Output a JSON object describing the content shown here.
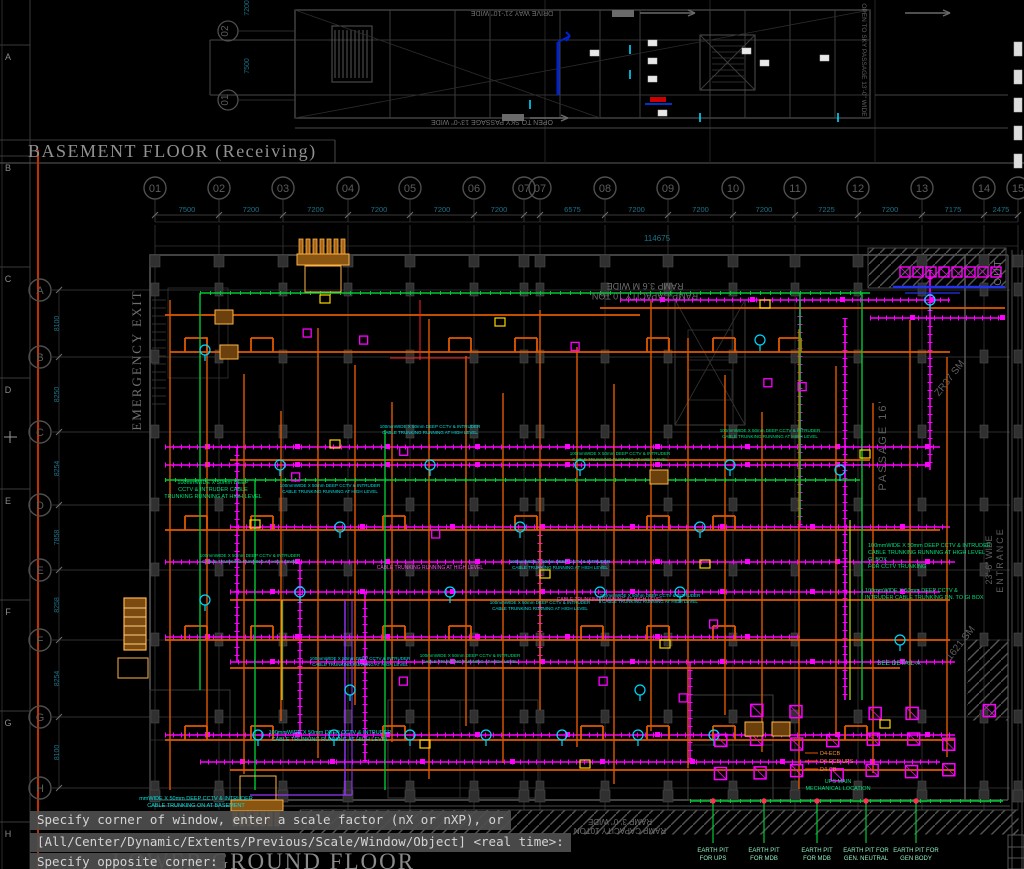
{
  "window": {
    "background": "#000000"
  },
  "titles": {
    "basement": "BASEMENT FLOOR (Receiving)",
    "ground_partial": "LOWER GROUND FLOOR"
  },
  "command_line": {
    "lines": [
      "Specify corner of window, enter a scale factor (nX or nXP), or",
      "[All/Center/Dynamic/Extents/Previous/Scale/Window/Object] <real time>:",
      "Specify opposite corner:"
    ]
  },
  "grid_columns": [
    {
      "label": "01",
      "x": 155,
      "dim_after": "7500"
    },
    {
      "label": "02",
      "x": 219,
      "dim_after": "7200"
    },
    {
      "label": "03",
      "x": 283,
      "dim_after": "7200"
    },
    {
      "label": "04",
      "x": 348,
      "dim_after": "7200"
    },
    {
      "label": "05",
      "x": 410,
      "dim_after": "7200"
    },
    {
      "label": "06",
      "x": 474,
      "dim_after": "7200"
    },
    {
      "label": "07",
      "x": 524,
      "dim_after": ""
    },
    {
      "label": "07",
      "x": 540,
      "dim_after": "6575"
    },
    {
      "label": "08",
      "x": 605,
      "dim_after": "7200"
    },
    {
      "label": "09",
      "x": 668,
      "dim_after": "7200"
    },
    {
      "label": "10",
      "x": 733,
      "dim_after": "7200"
    },
    {
      "label": "11",
      "x": 795,
      "dim_after": "7225"
    },
    {
      "label": "12",
      "x": 858,
      "dim_after": "7200"
    },
    {
      "label": "13",
      "x": 922,
      "dim_after": "7175"
    },
    {
      "label": "14",
      "x": 984,
      "dim_after": "2475"
    },
    {
      "label": "15",
      "x": 1018,
      "dim_after": ""
    }
  ],
  "grid_rows": [
    {
      "label": "A",
      "y": 290,
      "dim_after": "8100"
    },
    {
      "label": "B",
      "y": 357,
      "dim_after": "8250"
    },
    {
      "label": "C",
      "y": 432,
      "dim_after": "8254"
    },
    {
      "label": "D",
      "y": 505,
      "dim_after": "7858"
    },
    {
      "label": "E",
      "y": 570,
      "dim_after": "8258"
    },
    {
      "label": "F",
      "y": 640,
      "dim_after": "8254"
    },
    {
      "label": "G",
      "y": 717,
      "dim_after": "8100"
    },
    {
      "label": "H",
      "y": 788,
      "dim_after": ""
    }
  ],
  "overall_dim": "114675",
  "sheet_edge_letters": [
    "A",
    "B",
    "C",
    "D",
    "E",
    "F",
    "G",
    "H"
  ],
  "top_strip": {
    "bubbles": [
      {
        "label": "02"
      },
      {
        "label": "01"
      }
    ],
    "dims": [
      "7200",
      "7500"
    ],
    "drive_way": "DRIVE WAY 21'-10\" WIDE",
    "open_sky": "OPEN TO SKY PASSAGE 13'-0\" WIDE"
  },
  "labels": {
    "emergency_exit": "EMERGENCY EXIT",
    "ramp_capacity": "RAMP CAPACITY 10 TON",
    "ramp_width": "RAMP 3.6 M WIDE",
    "ramp_bottom_capacity": "RAMP CAPACITY 10TON",
    "ramp_bottom_width": "RAMP 3'-0\" WIDE",
    "passage": "PASSAGE 16'",
    "entrance_width": "23'-6\" WIDE",
    "entrance": "ENTRANCE",
    "out": "OUT",
    "zr37": "ZR37 SM",
    "sm1621": "1621 SM",
    "see_detail": "SEE DETAIL-A",
    "panels": [
      "D4-ECB",
      "D4-ECB-UPS",
      "D4-CB"
    ],
    "ups_main": [
      "UPS MAIN",
      "MECHANICAL LOCATION"
    ]
  },
  "notes": {
    "trunking_2l": [
      "100mmWIDE X 50mm DEEP CCTV & INTRUDER",
      "CABLE TRUNKING RUNNING AT HIGH LEVEL"
    ],
    "trunking_3l": [
      "100mmWIDE X 50mm DEEP",
      "CCTV & INTRUDER CABLE",
      "TRUNKING RUNNING AT HIGH LEVEL"
    ],
    "trunking_basement": [
      "mmWIDE X 50mm DEEP CCTV & INTRUDER",
      "CABLE TRUNKING ON AT BASEMENT"
    ],
    "trunking_right": [
      "100mmWIDE X 50mm DEEP CCTV & INTRUDER",
      "CABLE TRUNKING RUNNING AT HIGH LEVEL",
      "GI BOX",
      "FOR CCTV TRUNKING"
    ],
    "trunking_dn": [
      "100mmWIDE X 50mm DEEP CCTV &",
      "INTRUDER CABLE TRUNKING DN. TO GI BOX"
    ],
    "cable_high": "CABLE TRUNKING RUNNING AT HIGH LEVEL"
  },
  "earth_pits": [
    [
      "EARTH PIT",
      "FOR UPS"
    ],
    [
      "EARTH PIT",
      "FOR MDB"
    ],
    [
      "EARTH PIT",
      "FOR MDB"
    ],
    [
      "EARTH PIT FOR",
      "GEN. NEUTRAL"
    ],
    [
      "EARTH PIT FOR",
      "GEN BODY"
    ]
  ],
  "colors": {
    "magenta": "#ff00ff",
    "orange": "#e05800",
    "green": "#00c832",
    "cyan": "#00d8ff",
    "note_green": "#00e07a",
    "note_cyan": "#00e0e0",
    "teal_dim": "#1e7287",
    "yellow": "#ffd700",
    "tan": "#c87820",
    "gray_line": "#4a4a4a",
    "gray_text": "#8a8a8a",
    "red_line": "#c23000",
    "blue": "#2233ee",
    "purple": "#9933ff",
    "pit_text": "#8df0c0",
    "label_orange": "#ff9030"
  }
}
